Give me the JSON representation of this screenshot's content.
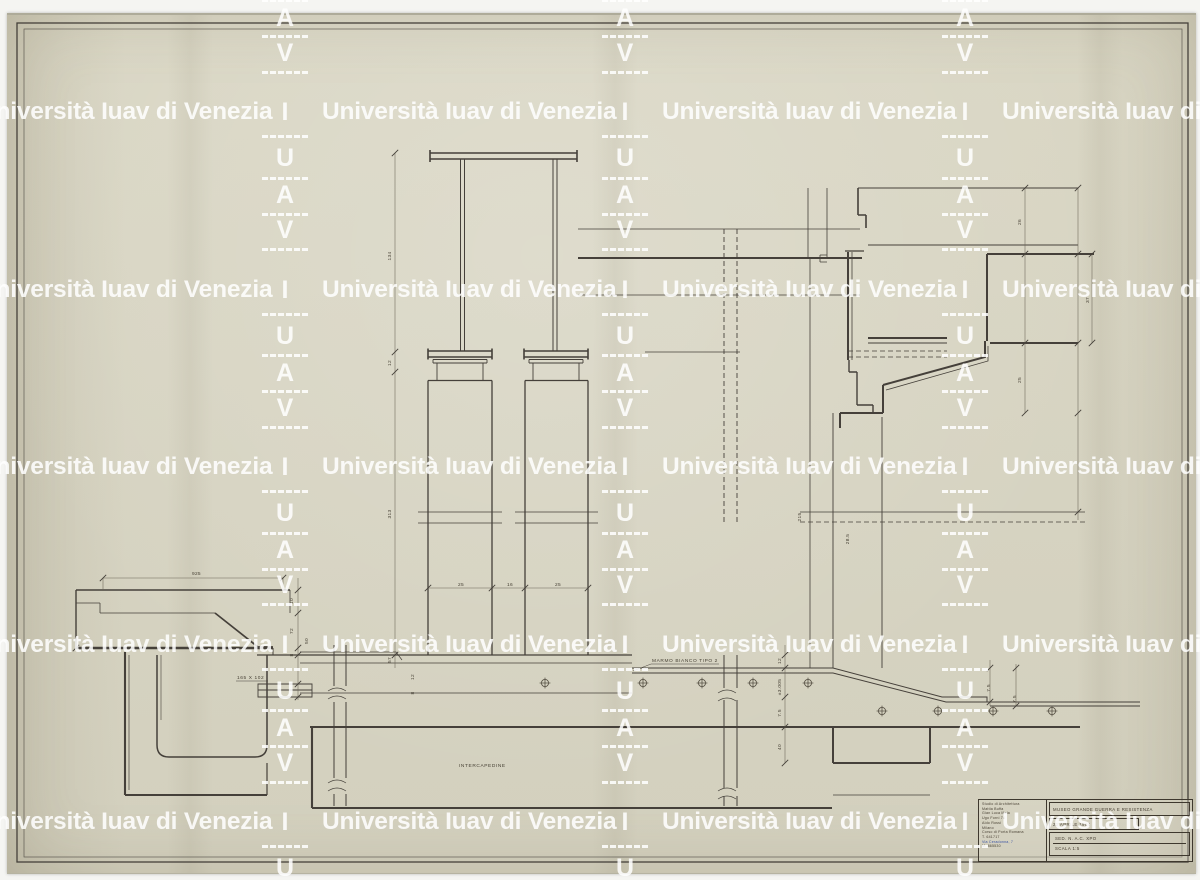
{
  "watermark": {
    "text": "Università Iuav di Venezia",
    "letters": [
      "I",
      "U",
      "A",
      "V"
    ],
    "color": "#ffffff"
  },
  "drawing_labels": [
    {
      "text": "MARMO BIANCO TIPO 2",
      "x": 652,
      "y": 662,
      "rot": 0
    },
    {
      "text": "INTERCAPEDINE",
      "x": 459,
      "y": 767,
      "rot": 0
    },
    {
      "text": "165 X 102",
      "x": 237,
      "y": 679,
      "rot": 0
    }
  ],
  "dimensions": [
    {
      "text": "925",
      "x": 192,
      "y": 575,
      "rot": 0
    },
    {
      "text": "134",
      "x": 391,
      "y": 256,
      "rot": -90
    },
    {
      "text": "12",
      "x": 391,
      "y": 363,
      "rot": -90
    },
    {
      "text": "313",
      "x": 391,
      "y": 514,
      "rot": -90
    },
    {
      "text": "57",
      "x": 391,
      "y": 660,
      "rot": -90
    },
    {
      "text": "25",
      "x": 458,
      "y": 586,
      "rot": 0
    },
    {
      "text": "16",
      "x": 507,
      "y": 586,
      "rot": 0
    },
    {
      "text": "25",
      "x": 555,
      "y": 586,
      "rot": 0
    },
    {
      "text": "26",
      "x": 1021,
      "y": 222,
      "rot": -90
    },
    {
      "text": "25",
      "x": 1021,
      "y": 380,
      "rot": -90
    },
    {
      "text": "37",
      "x": 1089,
      "y": 300,
      "rot": -90
    },
    {
      "text": "215",
      "x": 801,
      "y": 517,
      "rot": -90
    },
    {
      "text": "28.5",
      "x": 849,
      "y": 539,
      "rot": -90
    },
    {
      "text": "12",
      "x": 781,
      "y": 661,
      "rot": -90
    },
    {
      "text": "±3.005",
      "x": 781,
      "y": 687,
      "rot": -90
    },
    {
      "text": "7.5",
      "x": 781,
      "y": 713,
      "rot": -90
    },
    {
      "text": "40",
      "x": 781,
      "y": 747,
      "rot": -90
    },
    {
      "text": "7.5",
      "x": 990,
      "y": 688,
      "rot": -90
    },
    {
      "text": "7.5",
      "x": 1016,
      "y": 699,
      "rot": -90
    },
    {
      "text": "10",
      "x": 293,
      "y": 601,
      "rot": -90
    },
    {
      "text": "72",
      "x": 293,
      "y": 631,
      "rot": -90
    },
    {
      "text": "50",
      "x": 308,
      "y": 641,
      "rot": -90
    },
    {
      "text": "8",
      "x": 293,
      "y": 655,
      "rot": -90
    },
    {
      "text": "12",
      "x": 414,
      "y": 677,
      "rot": -90
    },
    {
      "text": "8",
      "x": 414,
      "y": 693,
      "rot": -90
    }
  ],
  "title_block": {
    "studio_lines": [
      "Studio di Architettura",
      "Mattia Buffa",
      "Gian Luca Mela",
      "Ugo Forni 74",
      "Aldo Rossi",
      "Milano",
      "Corso di Porta Romana",
      "T. 641717",
      "Via Ceradonna, 7",
      "M. 865530"
    ],
    "project": "MUSEO GRANDE GUERRA E RESISTENZA",
    "date": "22 APRILE 1964",
    "sheet_ref": "SED. N. A.C. XPO",
    "scale": "SCALA 1:5"
  }
}
